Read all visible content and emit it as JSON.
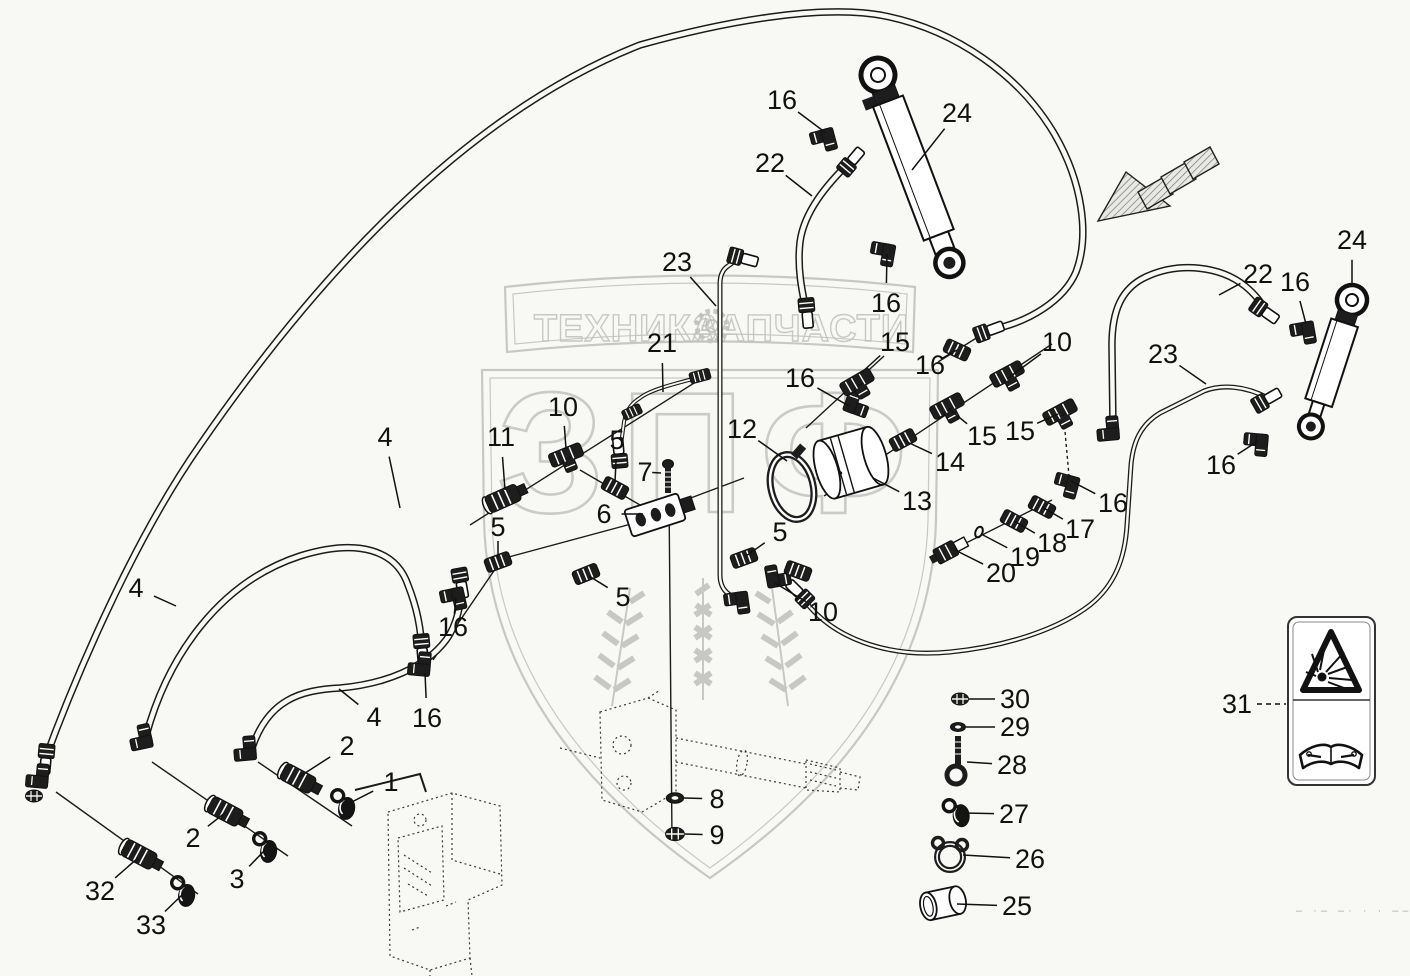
{
  "watermark": {
    "brand_left": "ТЕХНИКА",
    "brand_right": "ЗАПЧАСТИ",
    "big_letters": "ЗПФ",
    "color": "#bdbdbd"
  },
  "safety_label": {
    "number": "31",
    "icons": [
      "explosion-warning-icon",
      "read-manual-icon"
    ]
  },
  "footer_marks": "– ·– –· · · –– — –",
  "callouts": [
    {
      "label": "16",
      "x": 782,
      "y": 100,
      "tx": 826,
      "ty": 133
    },
    {
      "label": "24",
      "x": 957,
      "y": 113,
      "tx": 912,
      "ty": 170
    },
    {
      "label": "22",
      "x": 770,
      "y": 163,
      "tx": 812,
      "ty": 196
    },
    {
      "label": "23",
      "x": 677,
      "y": 262,
      "tx": 716,
      "ty": 306
    },
    {
      "label": "21",
      "x": 662,
      "y": 343,
      "tx": 663,
      "ty": 392
    },
    {
      "label": "16",
      "x": 886,
      "y": 303,
      "tx": 887,
      "ty": 254
    },
    {
      "label": "15",
      "x": 895,
      "y": 342,
      "tx": 860,
      "ty": 374
    },
    {
      "label": "16",
      "x": 930,
      "y": 365,
      "tx": 957,
      "ty": 350
    },
    {
      "label": "10",
      "x": 1057,
      "y": 342,
      "tx": 1011,
      "ty": 376
    },
    {
      "label": "16",
      "x": 800,
      "y": 378,
      "tx": 849,
      "ty": 406
    },
    {
      "label": "15",
      "x": 982,
      "y": 436,
      "tx": 949,
      "ty": 409
    },
    {
      "label": "15",
      "x": 1020,
      "y": 431,
      "tx": 1058,
      "ty": 414
    },
    {
      "label": "14",
      "x": 950,
      "y": 462,
      "tx": 903,
      "ty": 440
    },
    {
      "label": "13",
      "x": 917,
      "y": 501,
      "tx": 873,
      "ty": 478
    },
    {
      "label": "12",
      "x": 742,
      "y": 429,
      "tx": 787,
      "ty": 461
    },
    {
      "label": "16",
      "x": 1113,
      "y": 503,
      "tx": 1071,
      "ty": 481
    },
    {
      "label": "17",
      "x": 1080,
      "y": 529,
      "tx": 1042,
      "ty": 507
    },
    {
      "label": "18",
      "x": 1052,
      "y": 543,
      "tx": 1014,
      "ty": 521
    },
    {
      "label": "19",
      "x": 1025,
      "y": 557,
      "tx": 981,
      "ty": 534
    },
    {
      "label": "20",
      "x": 1001,
      "y": 573,
      "tx": 955,
      "ty": 550
    },
    {
      "label": "10",
      "x": 563,
      "y": 407,
      "tx": 566,
      "ty": 449
    },
    {
      "label": "11",
      "x": 501,
      "y": 437,
      "tx": 505,
      "ty": 490
    },
    {
      "label": "5",
      "x": 617,
      "y": 440,
      "tx": 615,
      "ty": 482
    },
    {
      "label": "7",
      "x": 645,
      "y": 472,
      "tx": 661,
      "ty": 473
    },
    {
      "label": "6",
      "x": 604,
      "y": 514,
      "tx": 643,
      "ty": 514
    },
    {
      "label": "5",
      "x": 498,
      "y": 527,
      "tx": 498,
      "ty": 558
    },
    {
      "label": "16",
      "x": 453,
      "y": 627,
      "tx": 456,
      "ty": 598
    },
    {
      "label": "16",
      "x": 427,
      "y": 718,
      "tx": 425,
      "ty": 673
    },
    {
      "label": "5",
      "x": 623,
      "y": 597,
      "tx": 589,
      "ty": 576
    },
    {
      "label": "10",
      "x": 823,
      "y": 612,
      "tx": 775,
      "ty": 583
    },
    {
      "label": "5",
      "x": 780,
      "y": 532,
      "tx": 746,
      "ty": 556
    },
    {
      "label": "4",
      "x": 385,
      "y": 437,
      "tx": 400,
      "ty": 508
    },
    {
      "label": "4",
      "x": 136,
      "y": 588,
      "tx": 176,
      "ty": 606
    },
    {
      "label": "4",
      "x": 374,
      "y": 717,
      "tx": 339,
      "ty": 689
    },
    {
      "label": "2",
      "x": 347,
      "y": 746,
      "tx": 299,
      "ty": 777
    },
    {
      "label": "1",
      "x": 391,
      "y": 782,
      "tx": 344,
      "ty": 806
    },
    {
      "label": "2",
      "x": 193,
      "y": 838,
      "tx": 226,
      "ty": 812
    },
    {
      "label": "3",
      "x": 237,
      "y": 879,
      "tx": 264,
      "ty": 851
    },
    {
      "label": "32",
      "x": 100,
      "y": 891,
      "tx": 138,
      "ty": 858
    },
    {
      "label": "33",
      "x": 151,
      "y": 925,
      "tx": 182,
      "ty": 895
    },
    {
      "label": "8",
      "x": 717,
      "y": 799,
      "tx": 684,
      "ty": 798
    },
    {
      "label": "9",
      "x": 717,
      "y": 835,
      "tx": 685,
      "ty": 834
    },
    {
      "label": "22",
      "x": 1258,
      "y": 274,
      "tx": 1219,
      "ty": 295
    },
    {
      "label": "16",
      "x": 1295,
      "y": 282,
      "tx": 1306,
      "ty": 324
    },
    {
      "label": "24",
      "x": 1352,
      "y": 240,
      "tx": 1352,
      "ty": 284
    },
    {
      "label": "23",
      "x": 1163,
      "y": 354,
      "tx": 1206,
      "ty": 384
    },
    {
      "label": "16",
      "x": 1221,
      "y": 465,
      "tx": 1258,
      "ty": 441
    },
    {
      "label": "30",
      "x": 1015,
      "y": 699,
      "tx": 969,
      "ty": 699
    },
    {
      "label": "29",
      "x": 1015,
      "y": 727,
      "tx": 966,
      "ty": 727
    },
    {
      "label": "28",
      "x": 1012,
      "y": 765,
      "tx": 967,
      "ty": 762
    },
    {
      "label": "27",
      "x": 1014,
      "y": 814,
      "tx": 964,
      "ty": 813
    },
    {
      "label": "26",
      "x": 1030,
      "y": 859,
      "tx": 963,
      "ty": 855
    },
    {
      "label": "25",
      "x": 1017,
      "y": 906,
      "tx": 957,
      "ty": 904
    },
    {
      "label": "31",
      "x": 1237,
      "y": 704,
      "tx": 1286,
      "ty": 704,
      "dash": true
    }
  ]
}
